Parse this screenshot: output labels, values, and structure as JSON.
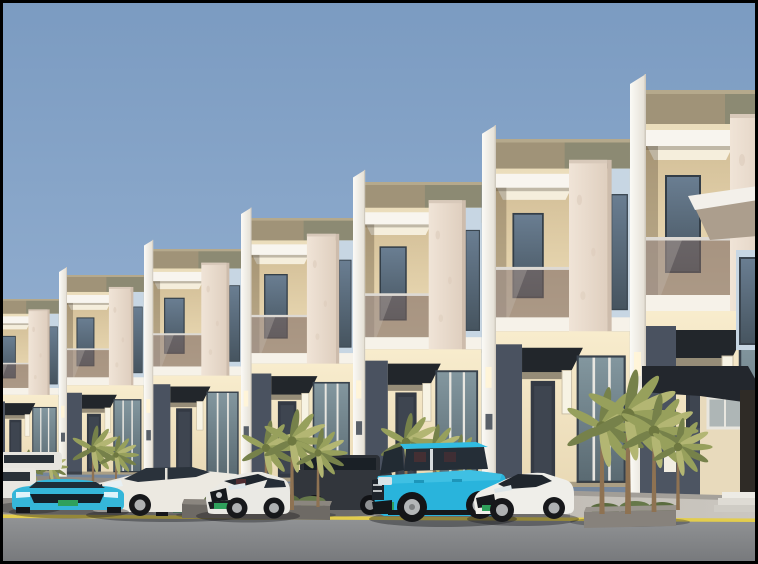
{
  "scene": {
    "kind": "architectural-3d-render",
    "subject": "row of modern two-story terrace townhouses with parked cars on street",
    "visible_text": "",
    "buildings_visible": 7,
    "palm_clusters": 5,
    "road_marking": "yellow-edge-line"
  },
  "colors": {
    "sky_top": "#7B9BC1",
    "sky_bottom": "#A3BCDA",
    "facade_white": "#F8F6F1",
    "facade_cream": "#F4E7C8",
    "parapet_tan": "#A09378",
    "parapet_olive": "#8C8A73",
    "marble": "#ECDFD2",
    "panel_blue": "#C7D6E3",
    "accent_navy": "#4A5260",
    "awning_black": "#22262B",
    "glass_window": "#5E7285",
    "balustrade_glass": "#7A6660",
    "lamp_glow": "#FFF4D8",
    "sidewalk": "#C2BEB6",
    "road": "#86888B",
    "curb_line_yellow": "#E3CD4D",
    "planter_dark": "#6E6A65",
    "planter_light": "#87827C",
    "palm_green": "#97A05C",
    "palm_green_dark": "#76814A",
    "palm_green_light": "#B3B673",
    "palm_trunk": "#8E7252",
    "shrub_green": "#5A6B3F",
    "license_plate": "#2FA05C",
    "tire": "#17181B",
    "rim": "#AFB1B3"
  },
  "cars": [
    {
      "name": "white-car-partial",
      "color": "#E9E7E1"
    },
    {
      "name": "cyan-sedan",
      "color": "#35B6D9"
    },
    {
      "name": "white-luxury-sedan",
      "color": "#ECE9E1"
    },
    {
      "name": "silver-suv",
      "color": "#A2A3A1"
    },
    {
      "name": "white-sport-sedan",
      "color": "#EAE9E4"
    },
    {
      "name": "dark-suv",
      "color": "#32363C"
    },
    {
      "name": "cyan-range-rover-suv",
      "color": "#29B4DC"
    },
    {
      "name": "white-coupe",
      "color": "#EFEEE9"
    }
  ]
}
